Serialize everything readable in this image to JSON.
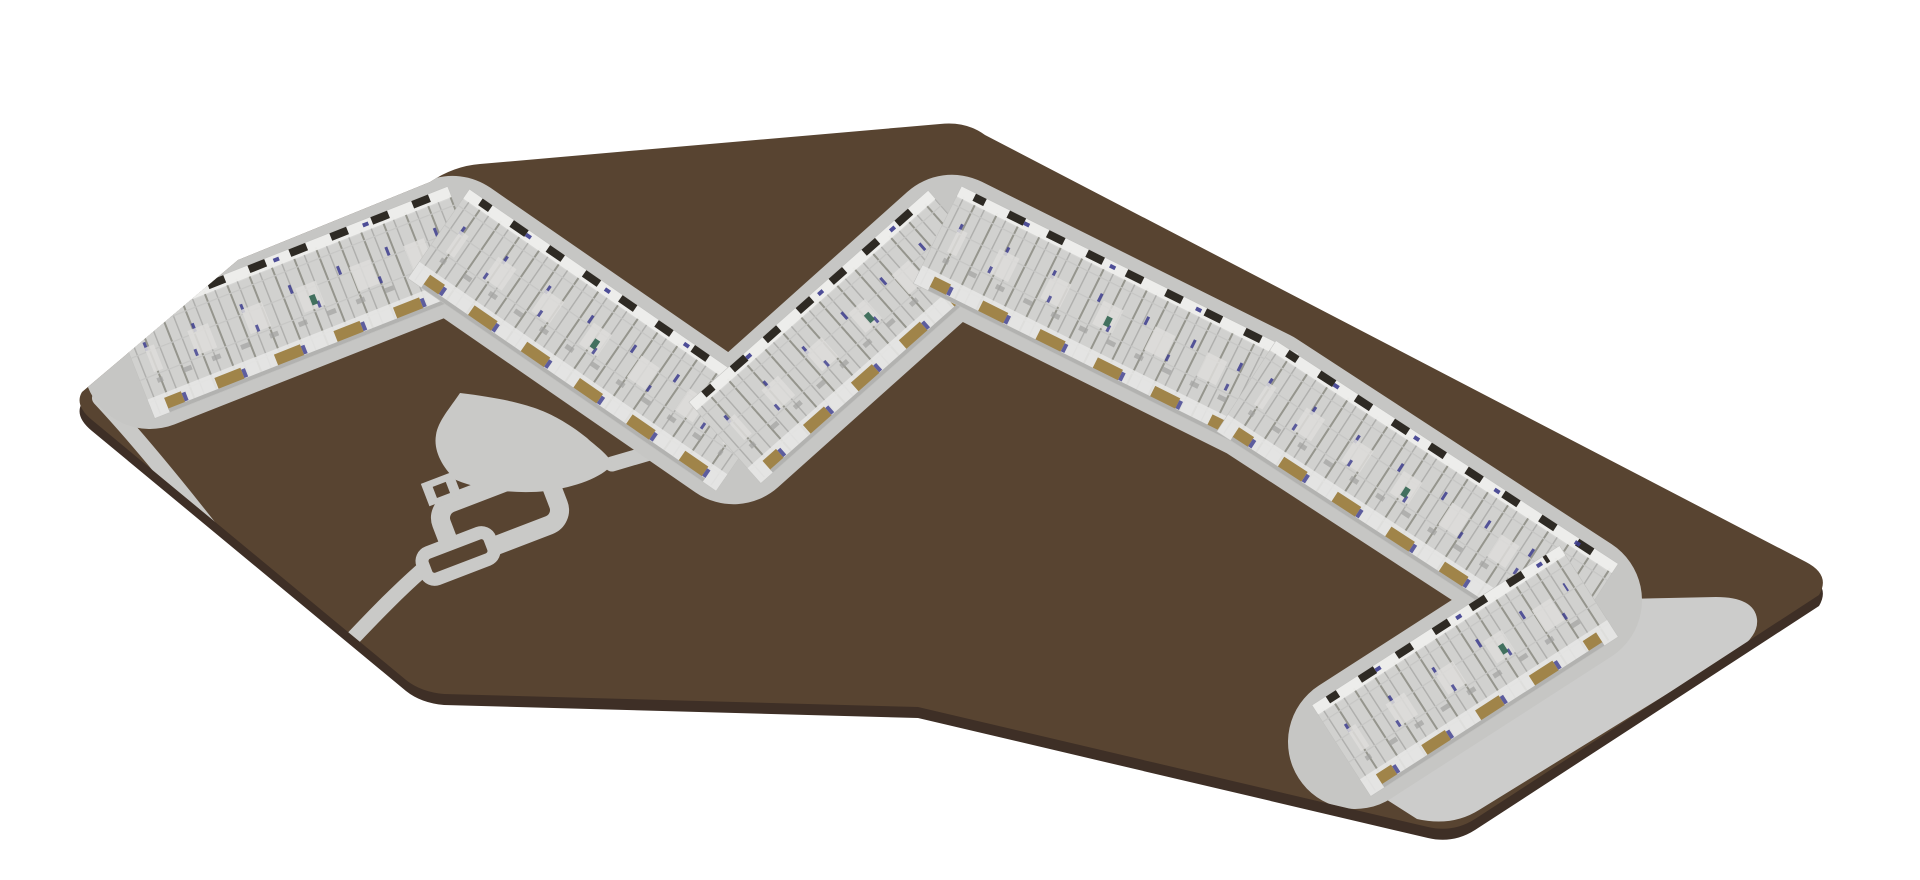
{
  "scene": {
    "type": "isometric-architectural-site-model",
    "view": "3d-axonometric"
  },
  "colors": {
    "background": "#ffffff",
    "site_ground": "#584431",
    "site_side": "#3e2f26",
    "path_gray": "#c9c9c7",
    "walkway": "#c6c6c4",
    "plaza": "#cccccb",
    "band_base": "#d7d7d5",
    "band_floor": "#d1d1cf",
    "wall_white": "#eeeeec",
    "hatch_line": "#95958d",
    "hatch_light": "#aeaeac",
    "hatch_cross": "#c6c6c4",
    "roof_dark": "#2e2a24",
    "facade_tan": "#a08449",
    "door_navy": "#3c3c8e",
    "door_teal": "#3a6b58",
    "inner_shadow": "#a3a3a1",
    "room_light": "#dedddb",
    "front_white": "#e6e6e4",
    "front_edge": "#b2b2b0",
    "band_outline": "#c0c0be"
  },
  "band": {
    "width": 108,
    "halo_width": 134,
    "legs": [
      {
        "x": 150,
        "y": 362,
        "angle": -21.5,
        "len": 325
      },
      {
        "x": 452,
        "y": 243,
        "angle": 34.6,
        "len": 342
      },
      {
        "x": 737,
        "y": 432,
        "angle": -41.5,
        "len": 287
      },
      {
        "x": 952,
        "y": 242,
        "angle": 26.4,
        "len": 344
      },
      {
        "x": 1260,
        "y": 395,
        "angle": 33.1,
        "len": 376
      },
      {
        "x": 1355,
        "y": 742,
        "angle": -32.8,
        "len": 262
      }
    ],
    "detail_rows": [
      {
        "y": -50,
        "w": 8,
        "color": "roof_dark",
        "dash": "18 26",
        "off": 6,
        "op": 1
      },
      {
        "y": -49,
        "w": 4,
        "color": "door_navy",
        "dash": "6 90",
        "off": 40,
        "op": 0.9
      },
      {
        "y": -16,
        "w": 9,
        "color": "door_navy",
        "dash": "3 49",
        "off": 0,
        "op": 0.85
      },
      {
        "y": -2,
        "w": 26,
        "color": "room_light",
        "dash": "22 36",
        "off": 12,
        "op": 0.85
      },
      {
        "y": 8,
        "w": 7,
        "color": "door_navy",
        "dash": "3 63",
        "off": 21,
        "op": 0.8
      },
      {
        "y": 2,
        "w": 10,
        "color": "door_teal",
        "dash": "6 230",
        "off": 64,
        "op": 0.95
      },
      {
        "y": 20,
        "w": 5,
        "color": "inner_shadow",
        "dash": "9 22",
        "off": 3,
        "op": 0.7
      },
      {
        "y": 45,
        "w": 13,
        "color": "facade_tan",
        "dash": "28 36",
        "off": 10,
        "op": 1
      },
      {
        "y": 45,
        "w": 9,
        "color": "door_navy",
        "dash": "4 60",
        "off": 46,
        "op": 0.8
      },
      {
        "y": 52,
        "w": 4,
        "color": "front_edge",
        "dash": "",
        "off": 0,
        "op": 1
      }
    ]
  },
  "landscape": {
    "features": [
      "perimeter-road-southwest",
      "leaf-shaped-pond-plaza",
      "courtyard-loop-path",
      "courtyard-islands",
      "pond-to-building-connector",
      "loop-to-road-connector",
      "entry-plaza-southeast"
    ]
  }
}
